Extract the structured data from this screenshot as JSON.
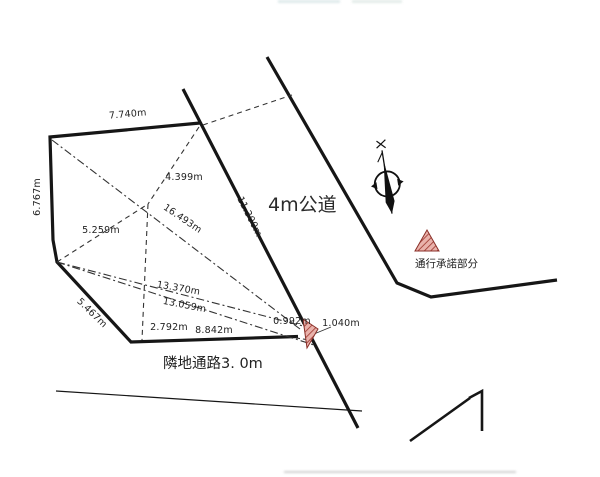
{
  "diagram": {
    "road_label": "4m公道",
    "passage_label": "隣地通路3. 0m",
    "consent_label": "通行承諾部分",
    "dims": {
      "top_edge": "7.740m",
      "left_edge": "6.767m",
      "upper_diagonal": "4.399m",
      "long_diagonal": "16.493m",
      "road_frontage": "11.300m",
      "mid_diagonal": "5.259m",
      "lower_diagonal_a": "13.370m",
      "lower_diagonal_b": "13.059m",
      "lower_left_edge": "5.467m",
      "bottom_segment_left": "2.792m",
      "bottom_segment_right": "8.842m",
      "corner_segment_left": "0.992m",
      "corner_segment_right": "1.040m"
    },
    "icons": {
      "compass": "north-arrow-icon",
      "consent_marker": "hatched-triangle"
    },
    "colors": {
      "line": "#161616",
      "text": "#222222",
      "triangle_fill": "#e9b2ab",
      "triangle_hatch": "#a03a32",
      "background": "#ffffff"
    }
  }
}
